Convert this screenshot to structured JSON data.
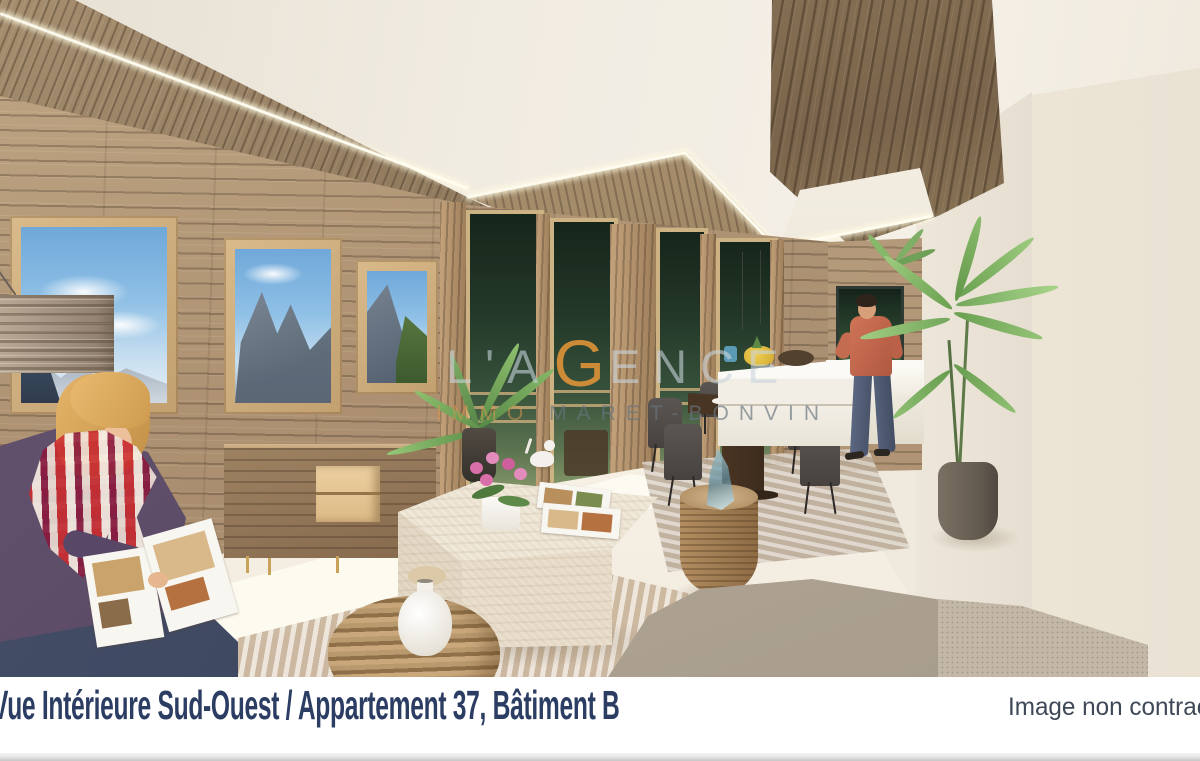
{
  "caption": {
    "title": "Vue Intérieure Sud-Ouest / Appartement 37, Bâtiment B",
    "note": "Image non contractuelle"
  },
  "watermark": {
    "line1_left": "L'A",
    "line1_g": "G",
    "line1_right": "ENCE",
    "line2_left": "IMMO",
    "line2_right": "MARET-BONVIN"
  },
  "colors": {
    "caption_text": "#2c3d63",
    "note_text": "#3e4857",
    "watermark_orange": "#e49438",
    "watermark_gray": "#68747f",
    "wood_wall": "#b2987a",
    "bottom_strip": "#c6c6c6"
  },
  "scene": {
    "alt": "3D rendering of an open-plan chalet apartment: wood-panelled walls, windows with mountain views, woman reading on the left, dining table and kitchen with a man, palm plants, stone coffee table and sofa"
  }
}
